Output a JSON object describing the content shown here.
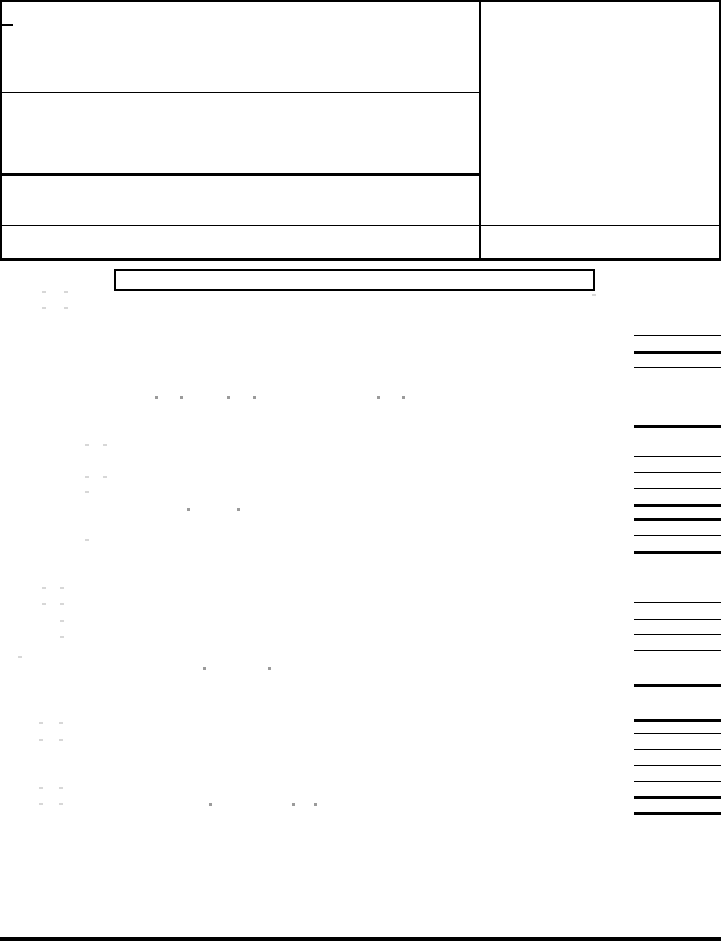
{
  "page": {
    "width": 721,
    "height": 944,
    "paper_color": "#ffffff",
    "ink_color": "#000000",
    "faint_mark_color": "#d7d7d7",
    "dot_mark_color": "#9b9b9b",
    "content_kind": "blank form page, no legible text rendered"
  },
  "header_block": {
    "outer": {
      "x": 0,
      "y": 0,
      "w": 721,
      "h": 261,
      "weight": 2
    },
    "divider_x": 479,
    "divider_w": 2,
    "corner_tick": {
      "x": 0,
      "y": 24,
      "w": 13,
      "weight": 2
    },
    "rules": [
      {
        "name": "header-row-rule-1",
        "x": 0,
        "y": 92,
        "w": 480,
        "weight": 1
      },
      {
        "name": "header-row-rule-2",
        "x": 0,
        "y": 173,
        "w": 480,
        "weight": 3
      },
      {
        "name": "header-row-rule-3",
        "x": 0,
        "y": 225,
        "w": 721,
        "weight": 1
      },
      {
        "name": "header-bottom-rule",
        "x": 0,
        "y": 258,
        "w": 721,
        "weight": 3
      }
    ]
  },
  "label_box": {
    "x": 114,
    "y": 269,
    "w": 481,
    "h": 22,
    "weight": 2
  },
  "amount_column": {
    "x": 634,
    "w": 87,
    "thin_weight": 1,
    "thick_weight": 3,
    "lines": [
      {
        "y": 335,
        "kind": "thin"
      },
      {
        "y": 351,
        "kind": "thick"
      },
      {
        "y": 367,
        "kind": "thin"
      },
      {
        "y": 425,
        "kind": "thick"
      },
      {
        "y": 456,
        "kind": "thin"
      },
      {
        "y": 472,
        "kind": "thin"
      },
      {
        "y": 488,
        "kind": "thin"
      },
      {
        "y": 504,
        "kind": "thick"
      },
      {
        "y": 518,
        "kind": "thick"
      },
      {
        "y": 535,
        "kind": "thin"
      },
      {
        "y": 551,
        "kind": "thick"
      },
      {
        "y": 602,
        "kind": "thin"
      },
      {
        "y": 619,
        "kind": "thin"
      },
      {
        "y": 634,
        "kind": "thin"
      },
      {
        "y": 650,
        "kind": "thin"
      },
      {
        "y": 684,
        "kind": "thick"
      },
      {
        "y": 719,
        "kind": "thick"
      },
      {
        "y": 733,
        "kind": "thin"
      },
      {
        "y": 749,
        "kind": "thin"
      },
      {
        "y": 765,
        "kind": "thin"
      },
      {
        "y": 781,
        "kind": "thin"
      },
      {
        "y": 796,
        "kind": "thick"
      },
      {
        "y": 812,
        "kind": "thick"
      }
    ]
  },
  "bottom_rule": {
    "x": 0,
    "y": 937,
    "w": 721,
    "h": 4
  },
  "marks": [
    {
      "x": 42,
      "y": 291,
      "kind": "faint"
    },
    {
      "x": 64,
      "y": 291,
      "kind": "faint"
    },
    {
      "x": 42,
      "y": 307,
      "kind": "faint"
    },
    {
      "x": 64,
      "y": 307,
      "kind": "faint"
    },
    {
      "x": 592,
      "y": 294,
      "kind": "faint"
    },
    {
      "x": 155,
      "y": 396,
      "kind": "dot"
    },
    {
      "x": 180,
      "y": 396,
      "kind": "dot"
    },
    {
      "x": 227,
      "y": 396,
      "kind": "dot"
    },
    {
      "x": 253,
      "y": 396,
      "kind": "dot"
    },
    {
      "x": 377,
      "y": 396,
      "kind": "dot"
    },
    {
      "x": 402,
      "y": 396,
      "kind": "dot"
    },
    {
      "x": 85,
      "y": 444,
      "kind": "faint"
    },
    {
      "x": 103,
      "y": 444,
      "kind": "faint"
    },
    {
      "x": 85,
      "y": 476,
      "kind": "faint"
    },
    {
      "x": 103,
      "y": 476,
      "kind": "faint"
    },
    {
      "x": 85,
      "y": 491,
      "kind": "faint"
    },
    {
      "x": 187,
      "y": 508,
      "kind": "dot"
    },
    {
      "x": 237,
      "y": 508,
      "kind": "dot"
    },
    {
      "x": 85,
      "y": 539,
      "kind": "faint"
    },
    {
      "x": 42,
      "y": 587,
      "kind": "faint"
    },
    {
      "x": 60,
      "y": 587,
      "kind": "faint"
    },
    {
      "x": 42,
      "y": 603,
      "kind": "faint"
    },
    {
      "x": 60,
      "y": 603,
      "kind": "faint"
    },
    {
      "x": 60,
      "y": 620,
      "kind": "faint"
    },
    {
      "x": 60,
      "y": 636,
      "kind": "faint"
    },
    {
      "x": 18,
      "y": 656,
      "kind": "faint"
    },
    {
      "x": 203,
      "y": 667,
      "kind": "dot"
    },
    {
      "x": 268,
      "y": 667,
      "kind": "dot"
    },
    {
      "x": 39,
      "y": 722,
      "kind": "faint"
    },
    {
      "x": 59,
      "y": 722,
      "kind": "faint"
    },
    {
      "x": 39,
      "y": 739,
      "kind": "faint"
    },
    {
      "x": 59,
      "y": 739,
      "kind": "faint"
    },
    {
      "x": 39,
      "y": 787,
      "kind": "faint"
    },
    {
      "x": 59,
      "y": 787,
      "kind": "faint"
    },
    {
      "x": 39,
      "y": 803,
      "kind": "faint"
    },
    {
      "x": 59,
      "y": 803,
      "kind": "faint"
    },
    {
      "x": 209,
      "y": 803,
      "kind": "dot"
    },
    {
      "x": 292,
      "y": 803,
      "kind": "dot"
    },
    {
      "x": 314,
      "y": 803,
      "kind": "dot"
    }
  ]
}
